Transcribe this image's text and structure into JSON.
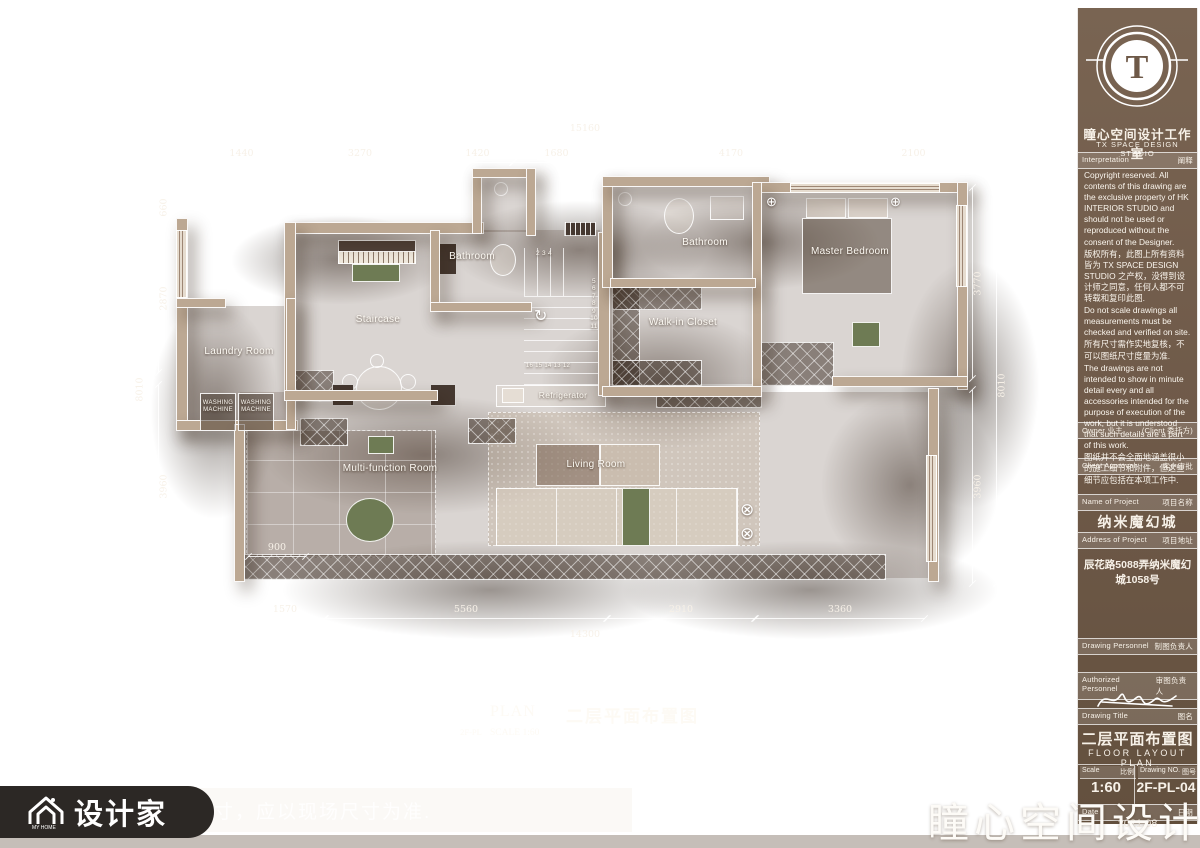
{
  "frame": {
    "watermark_fragment": "寸，应以现场尺寸为准.",
    "brand_badge_label": "设计家",
    "brand_badge_sub": "MY HOME",
    "studio_watermark": "瞳心空间设计"
  },
  "title_block": {
    "logo_letter": "T",
    "studio_name_cn": "瞳心空间设计工作室",
    "studio_name_en": "TX SPACE DESIGN STUDIO",
    "interpretation": {
      "label_en": "Interpretation",
      "label_cn": "阐释"
    },
    "copyright_paragraphs": [
      "Copyright reserved. All contents of this drawing are the exclusive property of HK INTERIOR STUDIO and should not be used or reproduced without the consent of the Designer.",
      "版权所有，此图上所有资料皆为 TX SPACE DESIGN STUDIO 之产权，没得到设计师之同意，任何人都不可转载和复印此图.",
      "Do not scale drawings all measurements must be checked and verified on site.",
      "所有尺寸需作实地复核，不可以图纸尺寸度量为准.",
      "The drawings are not intended to show in minute detail every and all accessories intended for the purpose of execution of the work, but it is understood that such details are a part of this work.",
      "图纸并不会全面地涵盖很小的施工细节和附件，但这些细节应包括在本项工作中."
    ],
    "owner": {
      "label_en": "Owner 业主",
      "label_cn": "(Client 委托方)"
    },
    "client_approval": {
      "label_en": "Client Approval",
      "label_cn": "客户审批"
    },
    "project": {
      "label_en": "Name of Project",
      "label_cn": "项目名称",
      "value": "纳米魔幻城"
    },
    "address": {
      "label_en": "Address of Project",
      "label_cn": "项目地址",
      "value": "辰花路5088弄纳米魔幻城1058号"
    },
    "drawing_personnel": {
      "label_en": "Drawing Personnel",
      "label_cn": "制图负责人"
    },
    "authorized_personnel": {
      "label_en": "Authorized Personnel",
      "label_cn": "审图负责人"
    },
    "drawing_title": {
      "label_en": "Drawing Title",
      "label_cn": "图名",
      "value_cn": "二层平面布置图",
      "value_en": "FLOOR LAYOUT PLAN"
    },
    "scale": {
      "label_en": "Scale",
      "label_cn": "比例",
      "value": "1:60"
    },
    "drawing_no": {
      "label_en": "Drawing NO.",
      "label_cn": "图号",
      "value": "2F-PL-04"
    },
    "date": {
      "label_en": "Date",
      "label_cn": "日期",
      "value": "2021.08"
    }
  },
  "plan": {
    "rooms": {
      "bathroom1": "Bathroom",
      "staircase": "Staircase",
      "laundry": "Laundry Room",
      "multifunction": "Multi-function Room",
      "living": "Living Room",
      "refrigerator": "Refrigerator",
      "walkin_closet": "Walk-in Closet",
      "bathroom2": "Bathroom",
      "master_bedroom": "Master Bedroom",
      "washing_machine": "WASHING\nMACHINE"
    },
    "stairs": {
      "top_numbers": "2  3  4",
      "right_numbers": "5\n6\n7\n8\n9\n10\n11",
      "bottom_numbers": "16 15 14 13 12"
    },
    "dimensions": {
      "top_total": "15160",
      "top_segments": [
        "1440",
        "3270",
        "1420",
        "1680",
        "4170",
        "2100"
      ],
      "left_total": "8010",
      "left_segments": [
        "660",
        "2870",
        "3960"
      ],
      "right_total": "8010",
      "right_segments": [
        "3770",
        "3960"
      ],
      "bottom_total": "14300",
      "bottom_segments": [
        "1570",
        "5560",
        "2910",
        "3360"
      ],
      "inner": "900"
    },
    "caption": {
      "tag": "2F-PL",
      "label": "PLAN",
      "scale": "SCALE  1:60",
      "title_cn": "二层平面布置图"
    }
  }
}
